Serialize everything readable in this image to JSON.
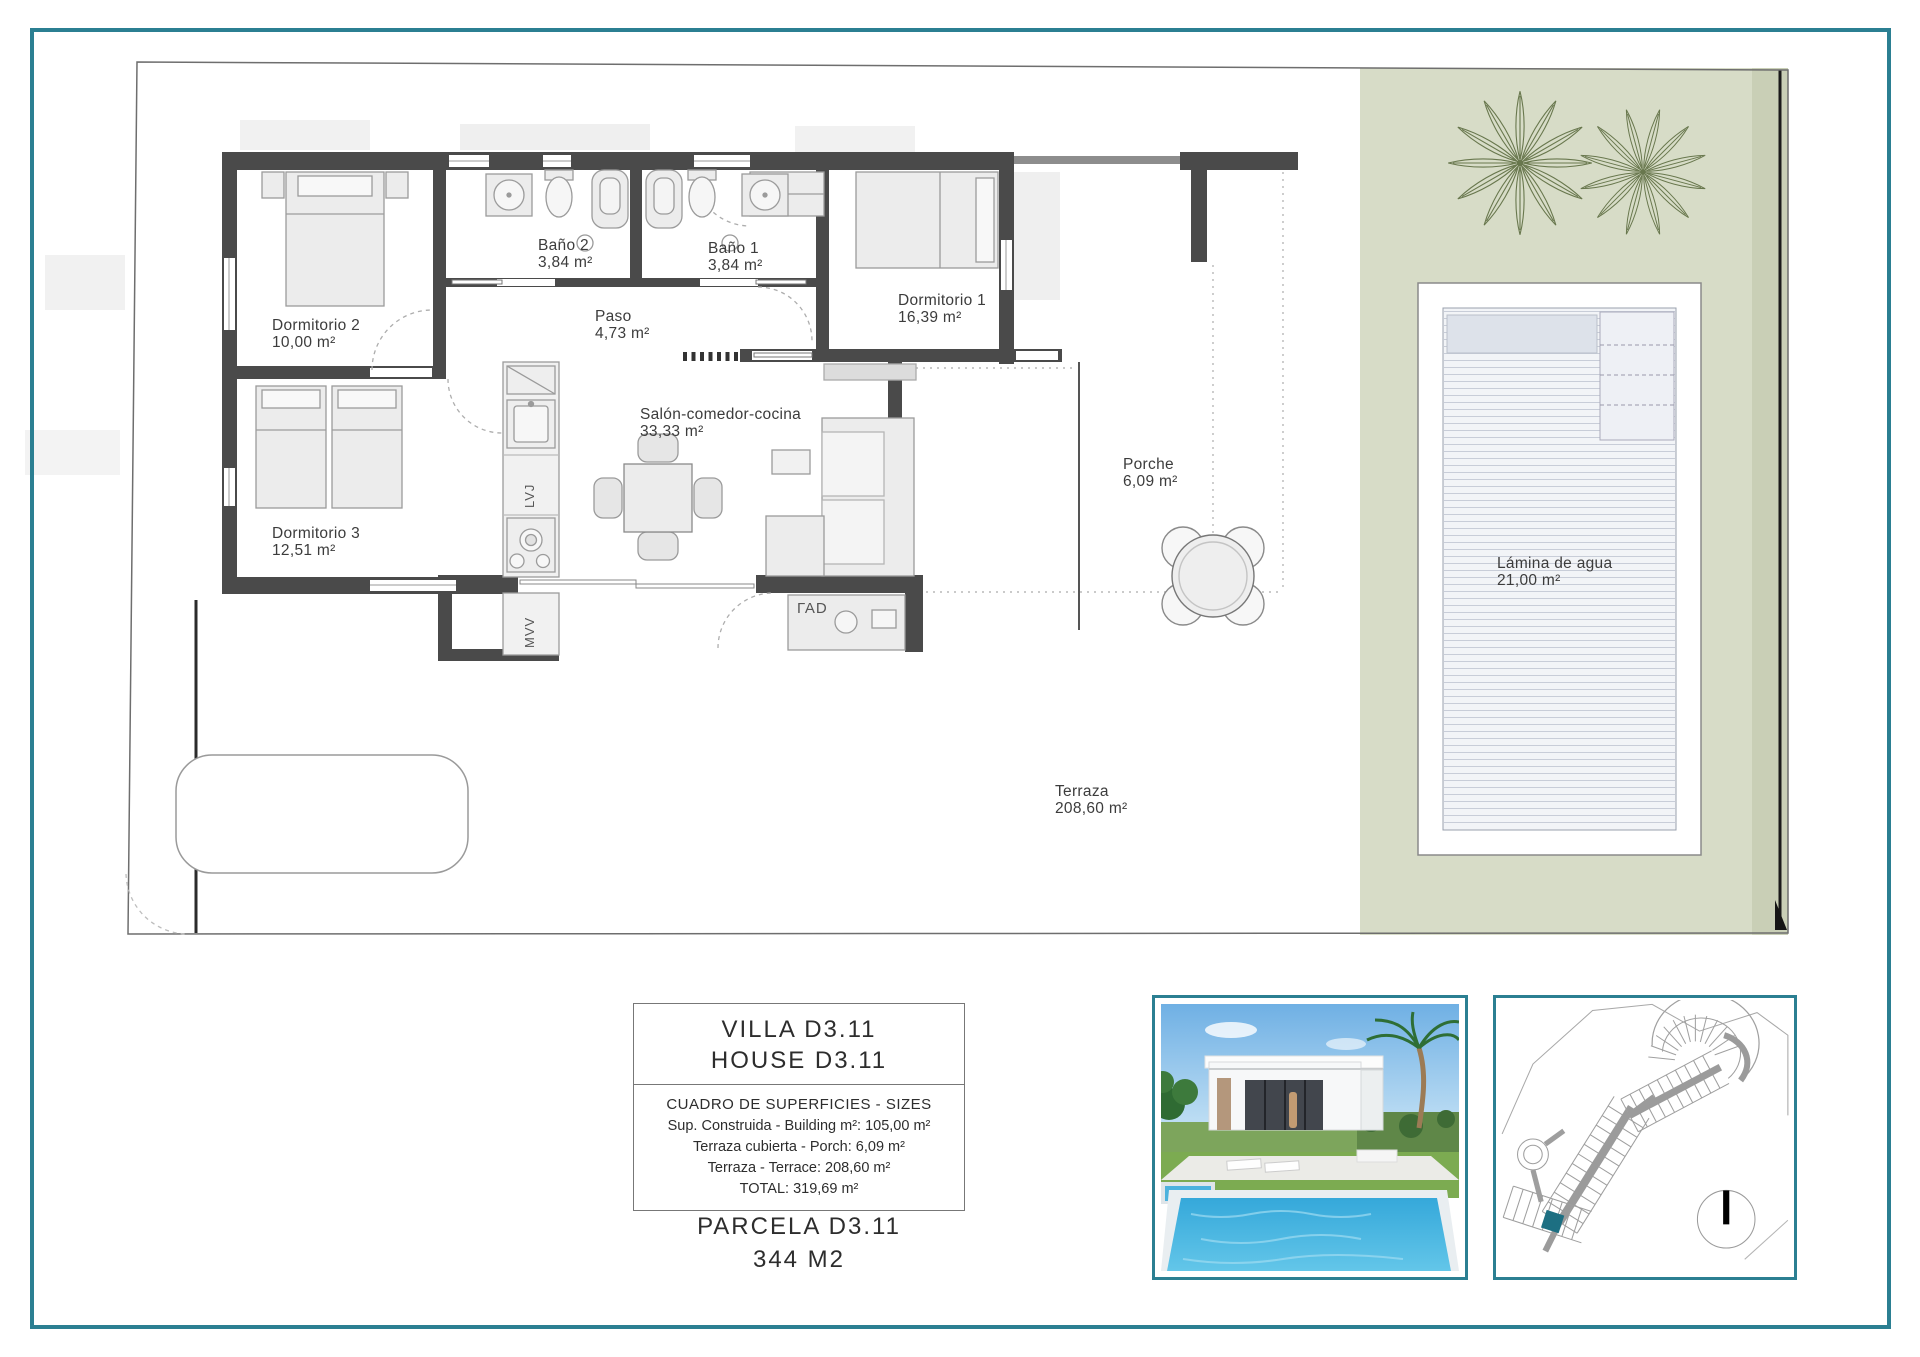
{
  "sheet": {
    "type": "architectural floor plan"
  },
  "colors": {
    "accent_teal": "#2b7f92",
    "garden_green": "#d7dcc7",
    "garden_band": "#c9cfb6",
    "wall_dark": "#4a4a4a",
    "map_parcel_teal": "#1d6f82"
  },
  "plan": {
    "rooms": [
      {
        "name": "Dormitorio 2",
        "area": "10,00 m²"
      },
      {
        "name": "Baño 2",
        "area": "3,84 m²"
      },
      {
        "name": "Baño 1",
        "area": "3,84 m²"
      },
      {
        "name": "Dormitorio 1",
        "area": "16,39 m²"
      },
      {
        "name": "Paso",
        "area": "4,73 m²"
      },
      {
        "name": "Salón-comedor-cocina",
        "area": "33,33 m²"
      },
      {
        "name": "Dormitorio 3",
        "area": "12,51 m²"
      },
      {
        "name": "Porche",
        "area": "6,09 m²"
      },
      {
        "name": "Terraza",
        "area": "208,60 m²"
      },
      {
        "name": "Lámina de agua",
        "area": "21,00 m²"
      }
    ],
    "appliances": {
      "dishwasher_label": "LVJ",
      "microwave_label": "MVV",
      "terrace_cabinet_label": "ΓΑD"
    }
  },
  "title_block": {
    "title_line1": "VILLA D3.11",
    "title_line2": "HOUSE D3.11",
    "table_header": "CUADRO DE SUPERFICIES  - SIZES",
    "rows": [
      "Sup. Construida  - Building m²: 105,00 m²",
      "Terraza cubierta  - Porch: 6,09 m²",
      "Terraza - Terrace: 208,60 m²",
      "TOTAL:  319,69 m²"
    ],
    "parcel_line1": "PARCELA D3.11",
    "parcel_line2": "344 M2"
  }
}
